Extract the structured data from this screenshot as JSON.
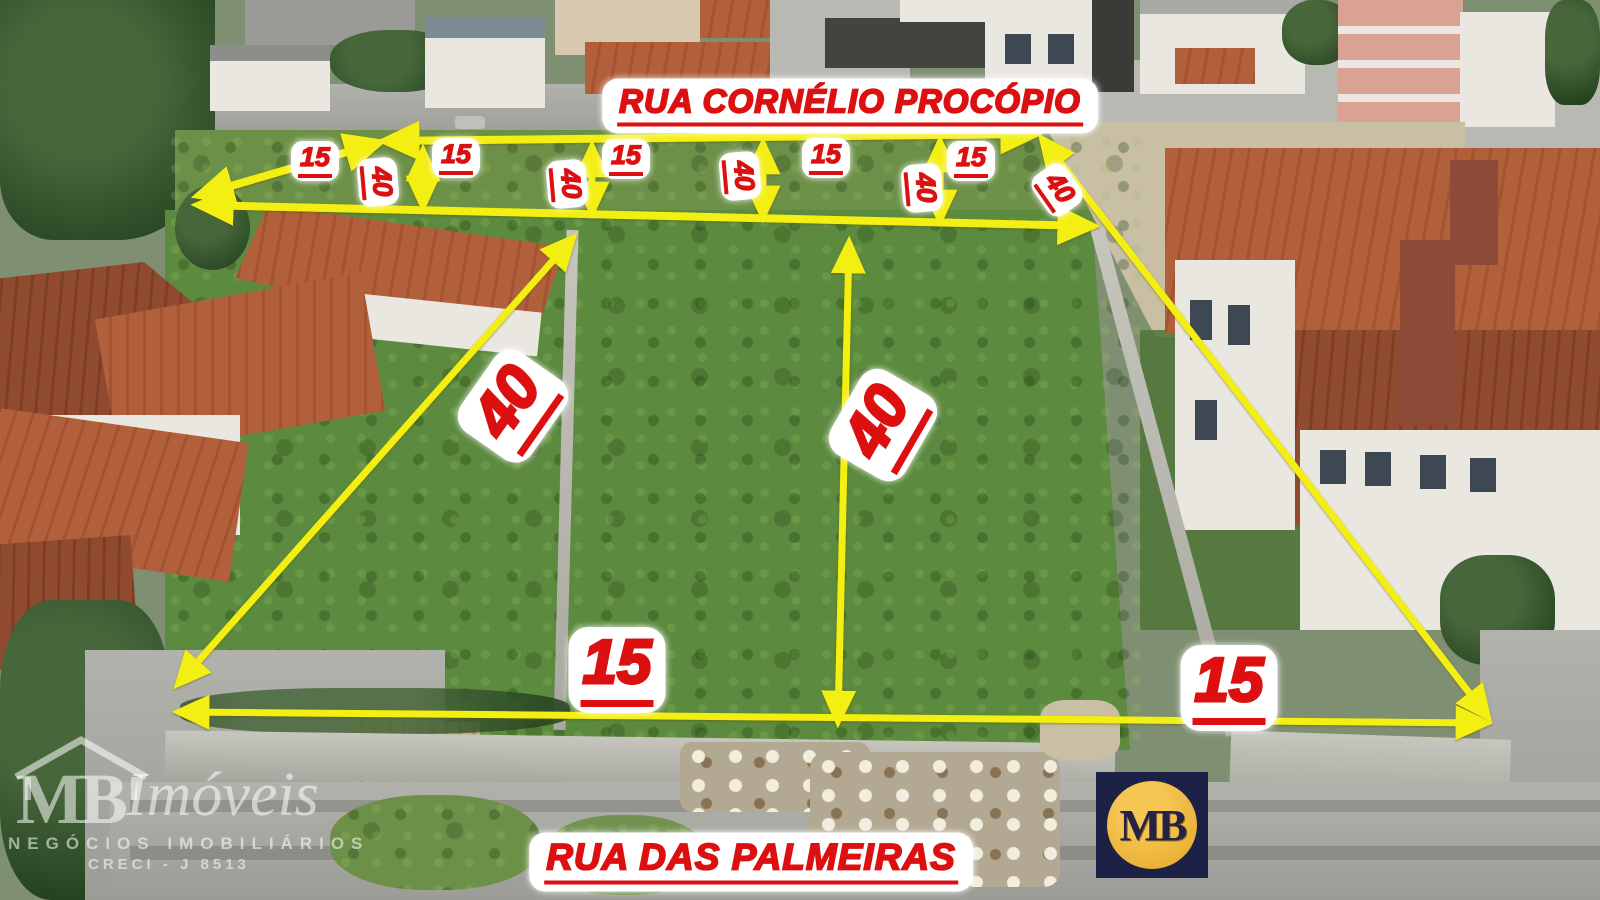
{
  "streets": {
    "top": "RUA CORNÉLIO PROCÓPIO",
    "bottom": "RUA DAS  PALMEIRAS"
  },
  "top_row_lots": [
    {
      "width": "15",
      "depth": "40"
    },
    {
      "width": "15",
      "depth": "40"
    },
    {
      "width": "15",
      "depth": "40"
    },
    {
      "width": "15",
      "depth": "40"
    },
    {
      "width": "15",
      "depth": "40"
    }
  ],
  "main_lots": {
    "left": {
      "depth": "40",
      "frontage": "15"
    },
    "right": {
      "depth": "40",
      "frontage": "15"
    }
  },
  "watermark": {
    "initials": "MB",
    "name": "Imóveis",
    "tagline": "NEGÓCIOS IMOBILIÁRIOS",
    "license": "CRECI - J 8513"
  },
  "logo": {
    "initials": "MB"
  },
  "colors": {
    "annotation_yellow": "#f4ef12",
    "annotation_red": "#dc1010",
    "logo_navy": "#1d2145",
    "logo_gold": "#e8ac2e"
  }
}
